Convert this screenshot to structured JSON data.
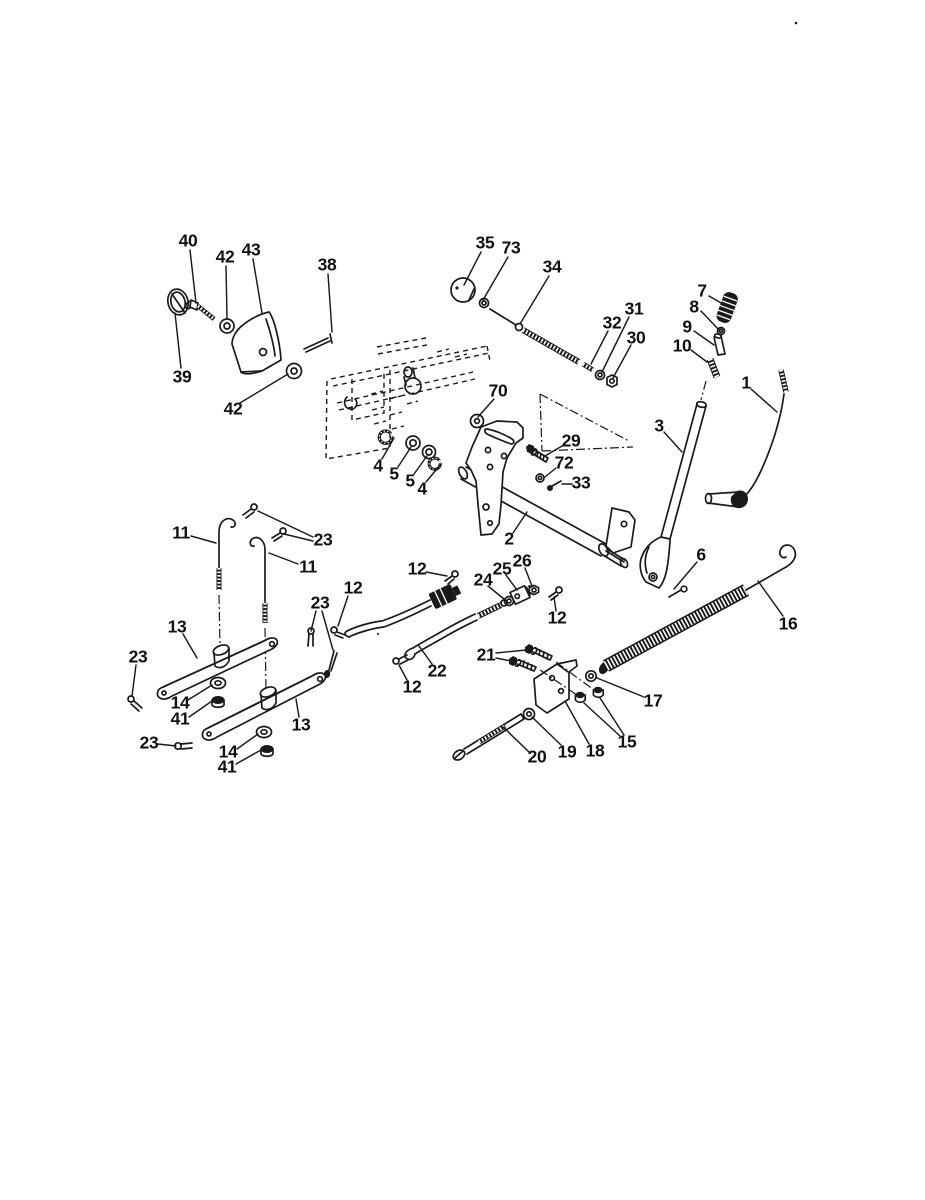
{
  "figure": {
    "type": "exploded-parts-diagram",
    "background": "#ffffff",
    "line_color": "#1a1a1a",
    "callouts": [
      {
        "label": "40",
        "x": 188,
        "y": 241,
        "leaders": [
          [
            190,
            250,
            196,
            303
          ]
        ]
      },
      {
        "label": "42",
        "x": 225,
        "y": 257,
        "leaders": [
          [
            226,
            266,
            227,
            319
          ]
        ]
      },
      {
        "label": "43",
        "x": 251,
        "y": 250,
        "leaders": [
          [
            253,
            259,
            262,
            313
          ]
        ]
      },
      {
        "label": "38",
        "x": 327,
        "y": 265,
        "leaders": [
          [
            328,
            274,
            332,
            332
          ]
        ]
      },
      {
        "label": "39",
        "x": 182,
        "y": 377,
        "leaders": [
          [
            181,
            368,
            175,
            313
          ]
        ]
      },
      {
        "label": "42",
        "x": 233,
        "y": 409,
        "leaders": [
          [
            240,
            403,
            288,
            374
          ]
        ]
      },
      {
        "label": "35",
        "x": 485,
        "y": 243,
        "leaders": [
          [
            481,
            252,
            464,
            285
          ]
        ]
      },
      {
        "label": "73",
        "x": 511,
        "y": 248,
        "leaders": [
          [
            508,
            257,
            483,
            300
          ]
        ]
      },
      {
        "label": "34",
        "x": 552,
        "y": 267,
        "leaders": [
          [
            549,
            276,
            520,
            324
          ]
        ]
      },
      {
        "label": "32",
        "x": 612,
        "y": 323,
        "leaders": [
          [
            608,
            331,
            591,
            364
          ]
        ]
      },
      {
        "label": "31",
        "x": 634,
        "y": 309,
        "leaders": [
          [
            629,
            317,
            602,
            372
          ]
        ]
      },
      {
        "label": "30",
        "x": 636,
        "y": 338,
        "leaders": [
          [
            631,
            345,
            613,
            378
          ]
        ]
      },
      {
        "label": "7",
        "x": 702,
        "y": 291,
        "leaders": [
          [
            709,
            296,
            721,
            303
          ]
        ]
      },
      {
        "label": "8",
        "x": 694,
        "y": 307,
        "leaders": [
          [
            701,
            311,
            719,
            330
          ]
        ]
      },
      {
        "label": "9",
        "x": 687,
        "y": 327,
        "leaders": [
          [
            694,
            331,
            714,
            345
          ]
        ]
      },
      {
        "label": "10",
        "x": 682,
        "y": 346,
        "leaders": [
          [
            691,
            350,
            707,
            362
          ]
        ]
      },
      {
        "label": "1",
        "x": 746,
        "y": 383,
        "leaders": [
          [
            751,
            389,
            777,
            412
          ]
        ]
      },
      {
        "label": "3",
        "x": 659,
        "y": 426,
        "leaders": [
          [
            664,
            432,
            682,
            452
          ]
        ]
      },
      {
        "label": "70",
        "x": 498,
        "y": 391,
        "leaders": [
          [
            494,
            399,
            478,
            417
          ]
        ]
      },
      {
        "label": "29",
        "x": 571,
        "y": 441,
        "leaders": [
          [
            562,
            446,
            545,
            456
          ]
        ]
      },
      {
        "label": "72",
        "x": 564,
        "y": 463,
        "leaders": [
          [
            556,
            468,
            545,
            477
          ]
        ]
      },
      {
        "label": "33",
        "x": 581,
        "y": 483,
        "leaders": [
          [
            572,
            484,
            562,
            484
          ]
        ]
      },
      {
        "label": "2",
        "x": 509,
        "y": 539,
        "leaders": [
          [
            513,
            533,
            527,
            512
          ]
        ]
      },
      {
        "label": "4",
        "x": 378,
        "y": 466,
        "leaders": [
          [
            382,
            459,
            394,
            438
          ]
        ]
      },
      {
        "label": "5",
        "x": 394,
        "y": 474,
        "leaders": [
          [
            398,
            467,
            411,
            447
          ]
        ]
      },
      {
        "label": "5",
        "x": 410,
        "y": 481,
        "leaders": [
          [
            414,
            474,
            427,
            456
          ]
        ]
      },
      {
        "label": "4",
        "x": 422,
        "y": 489,
        "leaders": [
          [
            426,
            482,
            441,
            464
          ]
        ]
      },
      {
        "label": "11",
        "x": 181,
        "y": 533,
        "leaders": [
          [
            191,
            536,
            216,
            543
          ]
        ]
      },
      {
        "label": "23",
        "x": 323,
        "y": 540,
        "leaders": [
          [
            313,
            537,
            258,
            511
          ],
          [
            313,
            541,
            284,
            534
          ]
        ]
      },
      {
        "label": "11",
        "x": 308,
        "y": 567,
        "leaders": [
          [
            298,
            564,
            269,
            553
          ]
        ]
      },
      {
        "label": "12",
        "x": 417,
        "y": 569,
        "leaders": [
          [
            426,
            572,
            447,
            576
          ]
        ]
      },
      {
        "label": "23",
        "x": 320,
        "y": 603,
        "leaders": [
          [
            316,
            611,
            311,
            631
          ],
          [
            322,
            611,
            333,
            650
          ]
        ]
      },
      {
        "label": "12",
        "x": 353,
        "y": 588,
        "leaders": [
          [
            348,
            596,
            338,
            626
          ]
        ]
      },
      {
        "label": "13",
        "x": 177,
        "y": 627,
        "leaders": [
          [
            183,
            634,
            197,
            658
          ]
        ]
      },
      {
        "label": "23",
        "x": 138,
        "y": 657,
        "leaders": [
          [
            136,
            665,
            132,
            696
          ]
        ]
      },
      {
        "label": "14",
        "x": 180,
        "y": 703,
        "leaders": [
          [
            188,
            700,
            212,
            685
          ]
        ]
      },
      {
        "label": "41",
        "x": 180,
        "y": 719,
        "leaders": [
          [
            189,
            717,
            212,
            701
          ]
        ]
      },
      {
        "label": "23",
        "x": 149,
        "y": 743,
        "leaders": [
          [
            158,
            744,
            176,
            746
          ]
        ]
      },
      {
        "label": "14",
        "x": 228,
        "y": 752,
        "leaders": [
          [
            237,
            749,
            258,
            734
          ]
        ]
      },
      {
        "label": "41",
        "x": 227,
        "y": 767,
        "leaders": [
          [
            236,
            764,
            261,
            750
          ]
        ]
      },
      {
        "label": "13",
        "x": 301,
        "y": 725,
        "leaders": [
          [
            299,
            717,
            296,
            699
          ]
        ]
      },
      {
        "label": "24",
        "x": 483,
        "y": 580,
        "leaders": [
          [
            488,
            586,
            504,
            599
          ]
        ]
      },
      {
        "label": "25",
        "x": 502,
        "y": 569,
        "leaders": [
          [
            506,
            575,
            517,
            590
          ]
        ]
      },
      {
        "label": "26",
        "x": 522,
        "y": 561,
        "leaders": [
          [
            525,
            568,
            532,
            586
          ]
        ]
      },
      {
        "label": "12",
        "x": 557,
        "y": 618,
        "leaders": [
          [
            556,
            611,
            554,
            597
          ]
        ]
      },
      {
        "label": "22",
        "x": 437,
        "y": 671,
        "leaders": [
          [
            432,
            664,
            419,
            646
          ]
        ]
      },
      {
        "label": "12",
        "x": 412,
        "y": 687,
        "leaders": [
          [
            407,
            680,
            399,
            665
          ]
        ]
      },
      {
        "label": "21",
        "x": 486,
        "y": 655,
        "leaders": [
          [
            496,
            653,
            526,
            650
          ],
          [
            496,
            658,
            511,
            661
          ]
        ]
      },
      {
        "label": "16",
        "x": 788,
        "y": 624,
        "leaders": [
          [
            783,
            616,
            758,
            581
          ]
        ]
      },
      {
        "label": "17",
        "x": 653,
        "y": 701,
        "leaders": [
          [
            644,
            697,
            597,
            678
          ]
        ]
      },
      {
        "label": "15",
        "x": 627,
        "y": 742,
        "leaders": [
          [
            620,
            736,
            584,
            703
          ],
          [
            624,
            735,
            600,
            698
          ]
        ]
      },
      {
        "label": "18",
        "x": 595,
        "y": 751,
        "leaders": [
          [
            589,
            744,
            565,
            701
          ]
        ]
      },
      {
        "label": "19",
        "x": 567,
        "y": 752,
        "leaders": [
          [
            561,
            745,
            532,
            717
          ]
        ]
      },
      {
        "label": "20",
        "x": 537,
        "y": 757,
        "leaders": [
          [
            529,
            752,
            503,
            727
          ]
        ]
      },
      {
        "label": "6",
        "x": 701,
        "y": 555,
        "leaders": [
          [
            697,
            562,
            674,
            589
          ]
        ]
      }
    ]
  }
}
